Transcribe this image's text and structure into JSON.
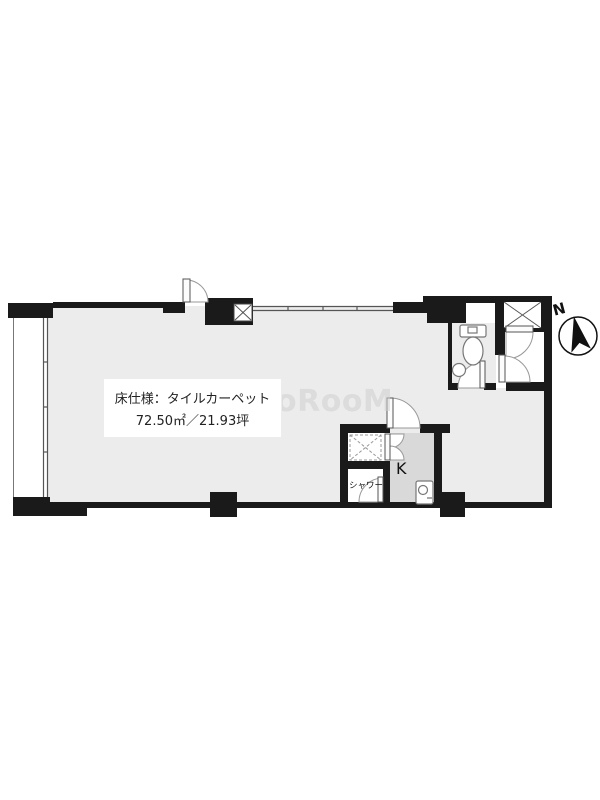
{
  "floorplan": {
    "spec_box": {
      "line1": "床仕様：タイルカーペット",
      "line2": "72.50㎡／21.93坪"
    },
    "labels": {
      "shower": "シャワー",
      "kitchen": "K"
    },
    "compass": {
      "north": "N"
    },
    "watermark": "oRooM",
    "area_sqm": "72.50",
    "area_tsubo": "21.93",
    "colors": {
      "wall": "#1a1a1a",
      "floor": "#ececec",
      "kitchen_floor": "#d9d9d9",
      "watermark": "#cfcfcf"
    }
  }
}
